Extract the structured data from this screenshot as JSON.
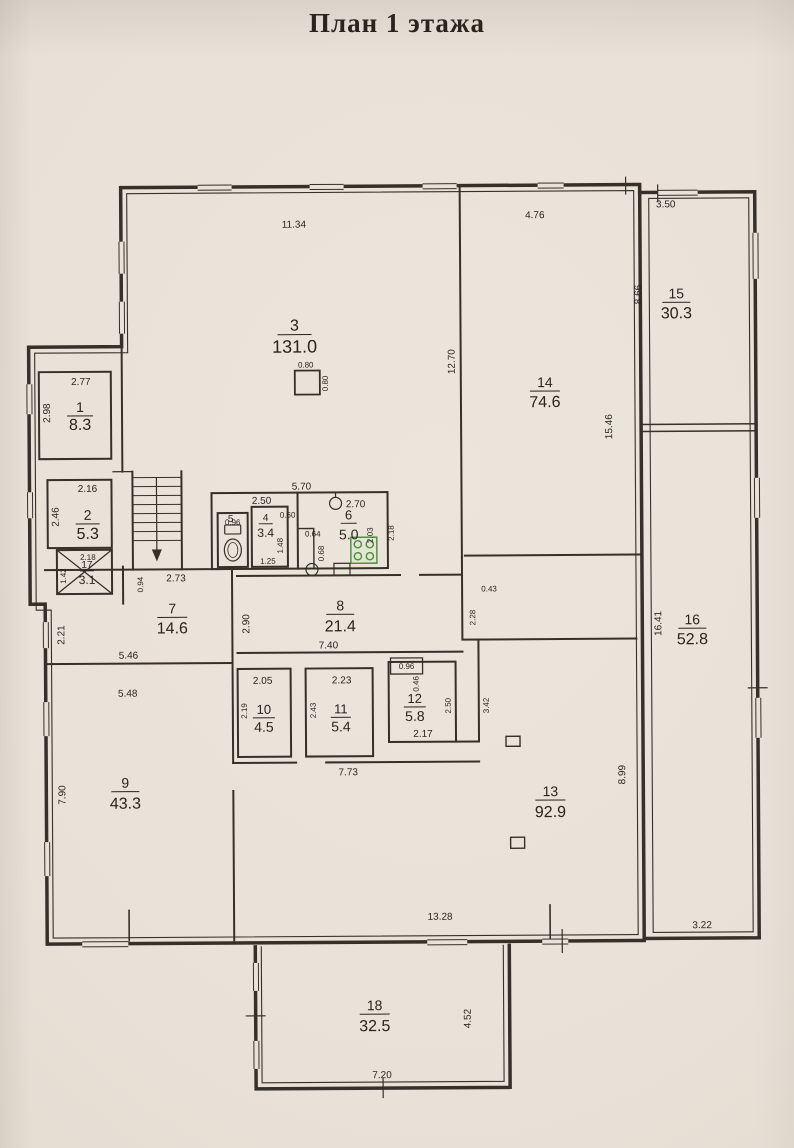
{
  "title": "План 1 этажа",
  "colors": {
    "paper": "#e9e2d9",
    "ink": "#35302a",
    "stove_green": "#4f8a3d"
  },
  "rooms": [
    {
      "number": "1",
      "area": "8.3"
    },
    {
      "number": "2",
      "area": "5.3"
    },
    {
      "number": "3",
      "area": "131.0"
    },
    {
      "number": "4",
      "area": "3.4"
    },
    {
      "number": "5",
      "area": ""
    },
    {
      "number": "6",
      "area": "5.0"
    },
    {
      "number": "7",
      "area": "14.6"
    },
    {
      "number": "8",
      "area": "21.4"
    },
    {
      "number": "9",
      "area": "43.3"
    },
    {
      "number": "10",
      "area": "4.5"
    },
    {
      "number": "11",
      "area": "5.4"
    },
    {
      "number": "12",
      "area": "5.8"
    },
    {
      "number": "13",
      "area": "92.9"
    },
    {
      "number": "14",
      "area": "74.6"
    },
    {
      "number": "15",
      "area": "30.3"
    },
    {
      "number": "16",
      "area": "52.8"
    },
    {
      "number": "17",
      "area": "3.1"
    },
    {
      "number": "18",
      "area": "32.5"
    }
  ],
  "dims": {
    "room3_top": "11.34",
    "room14_top": "4.76",
    "room15_top": "3.50",
    "room15_left": "8.66",
    "room3_right": "12.70",
    "room14_right": "15.46",
    "room1_top": "2.77",
    "room1_left": "2.98",
    "room2_top": "2.16",
    "room2_left": "2.46",
    "room17_top": "2.18",
    "room17_left": "1.42",
    "corridor7_left": "0.94",
    "corridor7_top": "2.73",
    "midblock_top": "5.70",
    "room4_top": "2.50",
    "room5_top": "0.96",
    "door4_top": "0.60",
    "room6_top": "2.70",
    "room6_right_inner": "2.03",
    "room6_right_outer": "2.18",
    "room6_inner_w": "0.64",
    "room6_inner_h": "0.68",
    "room4_right": "1.48",
    "room4_door": "1.25",
    "column_w": "0.80",
    "column_h": "0.80",
    "room7_left": "2.21",
    "room7_bottom": "5.46",
    "room8_left": "2.90",
    "room8_bottom": "7.40",
    "gap8_top": "0.43",
    "gap8_right": "2.28",
    "room9_top": "5.48",
    "room9_left": "7.90",
    "room10_top": "2.05",
    "room10_left": "2.19",
    "room11_top": "2.23",
    "room11_left": "2.43",
    "room12_top": "0.96",
    "room12_niche": "0.46",
    "room12_right": "2.50",
    "room12_gap": "3.42",
    "room12_bottom": "2.17",
    "corridor13_top": "7.73",
    "room13_right": "8.99",
    "room13_bottom": "13.28",
    "room16_left": "16.41",
    "room16_bottom": "3.22",
    "room18_bottom": "7.20",
    "room18_right": "4.52"
  }
}
